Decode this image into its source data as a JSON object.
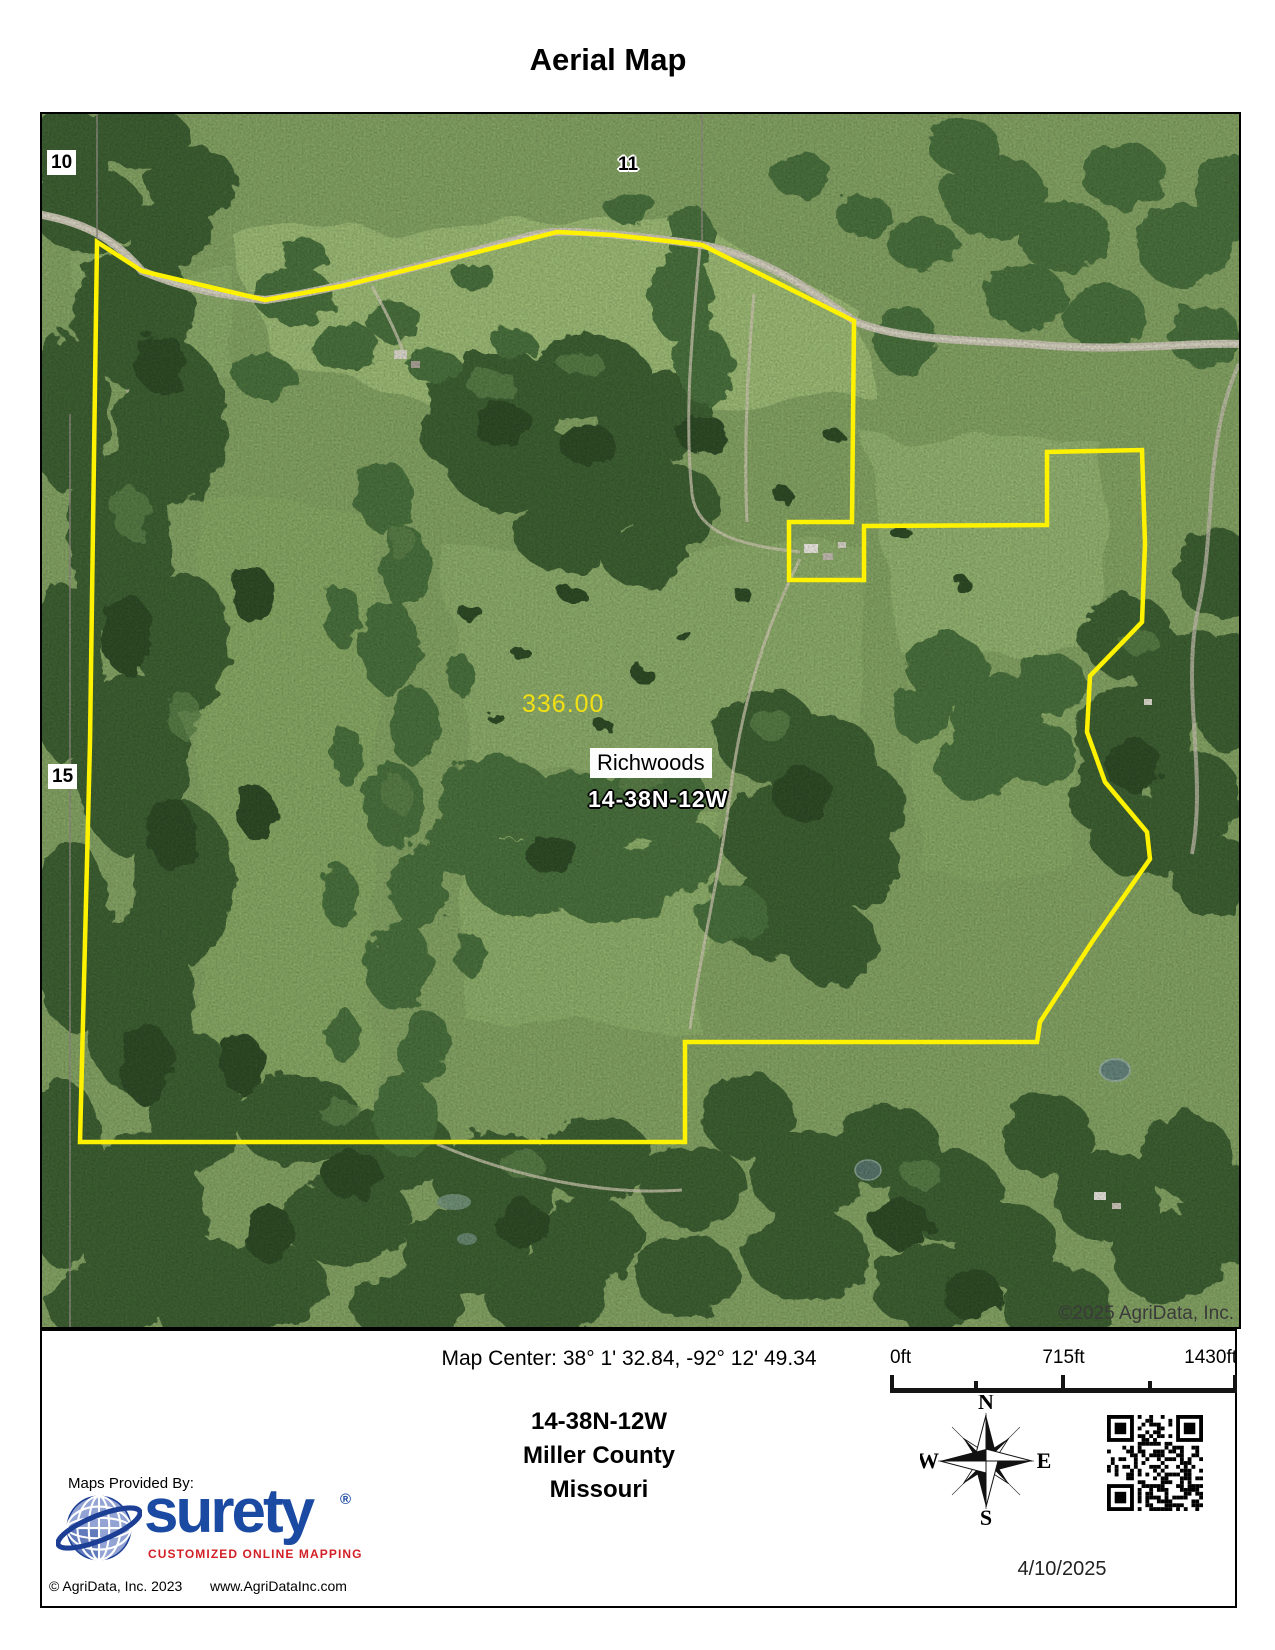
{
  "page": {
    "title": "Aerial Map"
  },
  "map": {
    "section_labels": [
      {
        "text": "10"
      },
      {
        "text": "11"
      },
      {
        "text": "15"
      }
    ],
    "acreage_label": "336.00",
    "place_label": "Richwoods",
    "township_overlay": "14-38N-12W",
    "watermark": "©2025 AgriData, Inc.",
    "colors": {
      "boundary": "#fff200",
      "acreage_text": "#f2e015",
      "field_green": "#83a263",
      "forest_green": "#3c5e33",
      "road": "#c8c4b2"
    }
  },
  "footer": {
    "map_center": "Map Center: 38° 1' 32.84,  -92° 12' 49.34",
    "scale_bar": {
      "labels": [
        "0ft",
        "715ft",
        "1430ft"
      ]
    },
    "location": {
      "township": "14-38N-12W",
      "county": "Miller County",
      "state": "Missouri"
    },
    "compass": {
      "north": "N",
      "east": "E",
      "south": "S",
      "west": "W"
    },
    "provider": {
      "intro": "Maps Provided By:",
      "brand": "surety",
      "registered": "®",
      "tagline": "CUSTOMIZED ONLINE MAPPING"
    },
    "copyright": "© AgriData, Inc. 2023",
    "website": "www.AgriDataInc.com",
    "date": "4/10/2025"
  }
}
